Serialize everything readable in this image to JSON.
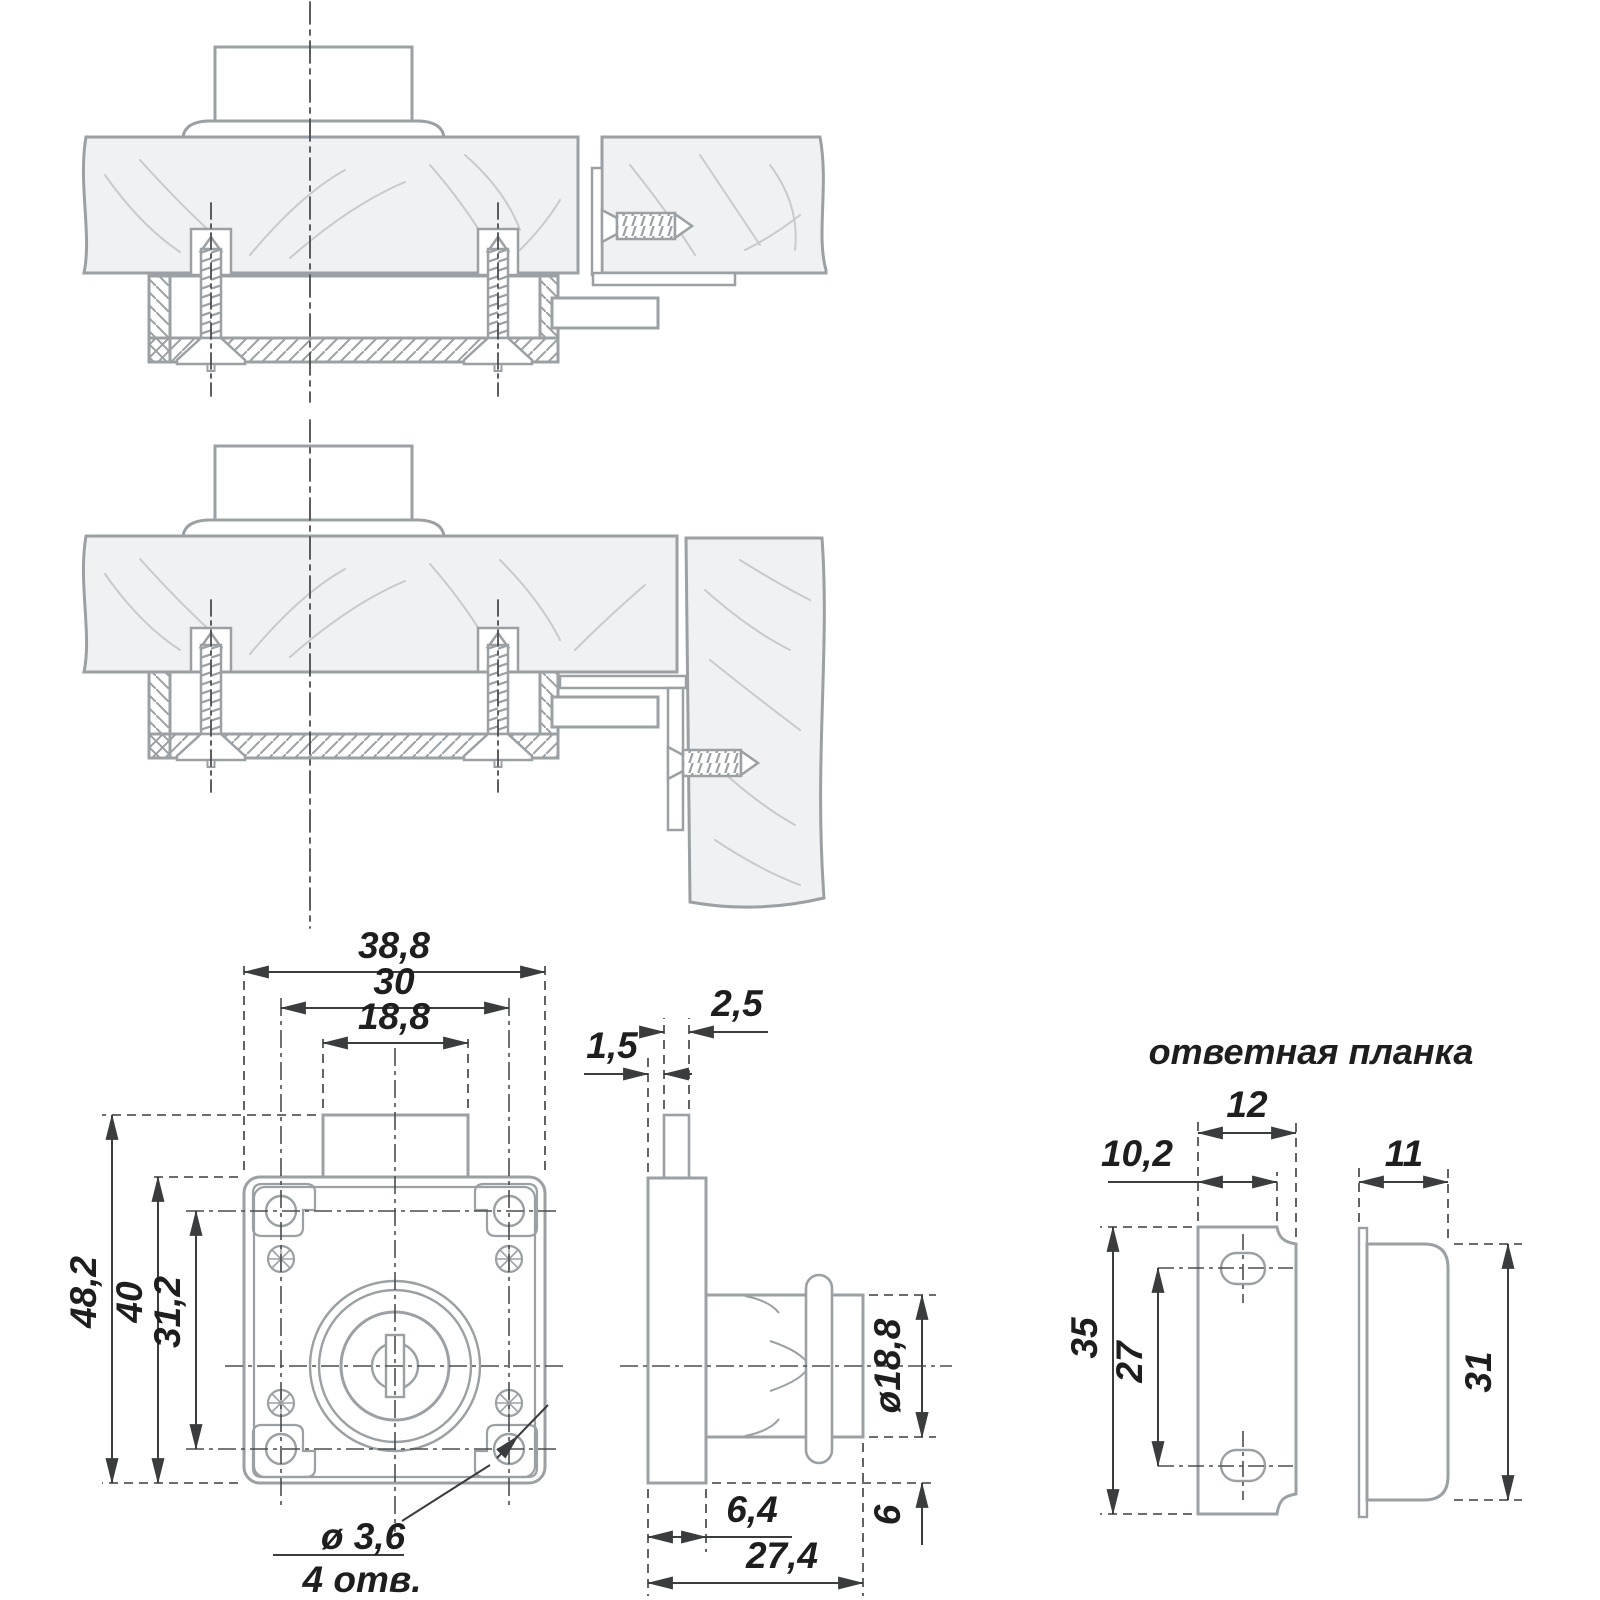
{
  "document": {
    "type": "technical-drawing",
    "subject": "furniture drawer lock with strike plate",
    "language": "ru"
  },
  "colors": {
    "outline_gray": "#9aa0a3",
    "grain_gray": "#c7cbcd",
    "wood_fill": "#f0f1f2",
    "dimension_dark": "#3a3c3e",
    "text_dark": "#1e1e1e",
    "background": "#ffffff"
  },
  "lock_front": {
    "width": "38,8",
    "screw_spacing_h": "30",
    "neck_width": "18,8",
    "total_height": "48,2",
    "body_height": "40",
    "screw_spacing_v": "31,2",
    "mount_hole_dia": "ø 3,6",
    "mount_hole_count": "4 отв."
  },
  "lock_side": {
    "cam_offset": "1,5",
    "cam_width": "2,5",
    "cylinder_dia": "ø18,8",
    "flange_offset": "6",
    "plate_thickness": "6,4",
    "total_depth": "27,4"
  },
  "strike_plate": {
    "title": "ответная планка",
    "front_width": "12",
    "front_inner_width": "10,2",
    "front_height": "35",
    "hole_spacing": "27",
    "side_depth": "11",
    "side_height": "31"
  }
}
